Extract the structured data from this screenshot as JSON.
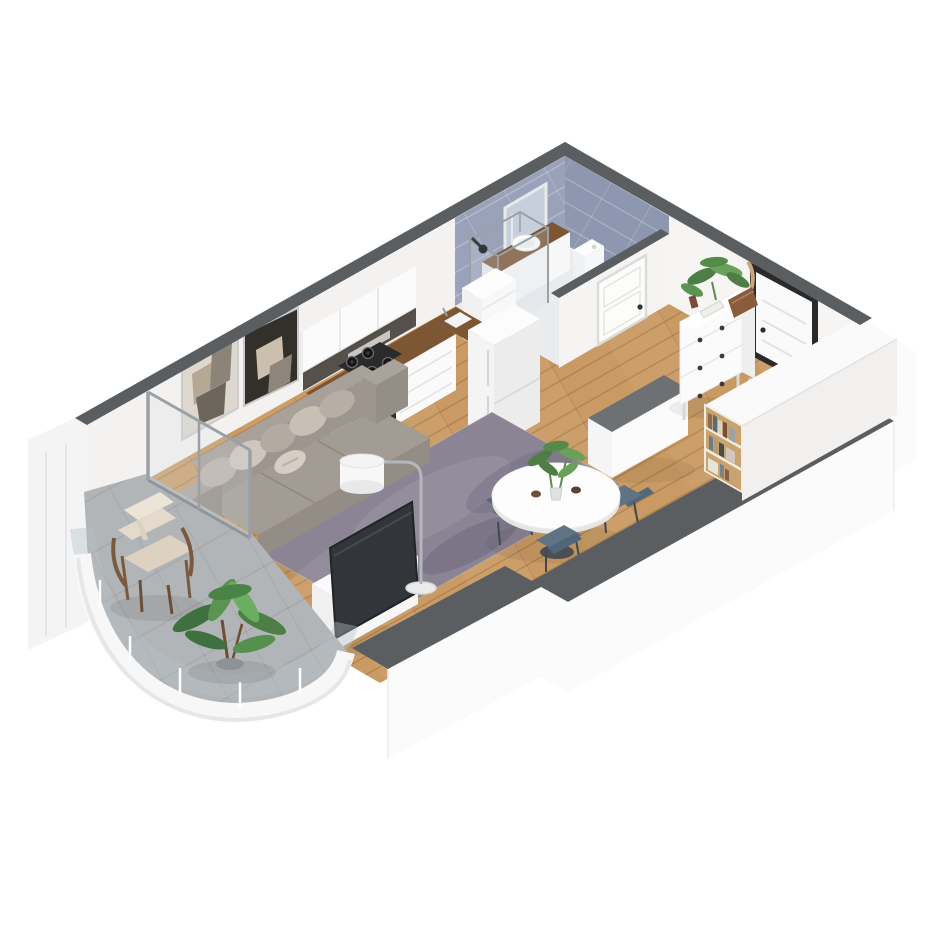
{
  "scene": {
    "description": "Isometric 3D rendering of a studio apartment floor plan, viewed from above at an angle, cut-away walls",
    "projection": "isometric",
    "rooms": [
      {
        "name": "bathroom",
        "items": [
          "shower-enclosure",
          "shower-head",
          "mirror-cabinet",
          "vanity-sink",
          "toilet",
          "bathroom-cabinet",
          "bathroom-door"
        ]
      },
      {
        "name": "kitchen",
        "items": [
          "upper-cabinets",
          "extractor",
          "gas-hob",
          "oven",
          "base-cabinets",
          "kitchen-sink",
          "fridge"
        ]
      },
      {
        "name": "living-room",
        "items": [
          "sofa",
          "throw-pillows",
          "area-rug",
          "tv",
          "tv-stand",
          "arc-floor-lamp",
          "wall-art-light",
          "wall-art-dark",
          "sliding-glass-door"
        ]
      },
      {
        "name": "dining-area",
        "items": [
          "round-dining-table",
          "dining-chair-left",
          "dining-chair-right",
          "dining-chair-front",
          "plant-centerpiece",
          "console-table"
        ]
      },
      {
        "name": "entry-hall",
        "items": [
          "chest-of-drawers",
          "potted-plant",
          "decor-basket",
          "entry-door",
          "wardrobe-partition",
          "bookshelf"
        ]
      },
      {
        "name": "balcony",
        "items": [
          "armchair",
          "throw-blanket",
          "potted-plant-large",
          "curved-glass-railing",
          "side-panel"
        ]
      }
    ],
    "colors": {
      "bg": "#ffffff",
      "wall_top": "#5b5e61",
      "wall_face": "#f4f2f0",
      "wall_outer": "#fbfbfb",
      "tile_nw": "#9aa2ba",
      "tile_ne": "#8e97b0",
      "floor_wood": "#c99a63",
      "floor_bath": "#e9ebee",
      "floor_balcony": "#b2b5b7",
      "rug": "#8b8494",
      "sofa": "#a39c95",
      "sofa_dark": "#948d86",
      "pillow_light": "#cfc7bd",
      "chair": "#5f7384",
      "counter_wood": "#7d5634",
      "backsplash": "#56504b",
      "cabinet_white": "#fafafa",
      "appliance_dark": "#2c2d2f",
      "plant_green": "#4e7d46",
      "plant_green_light": "#6aa05a",
      "bookshelf_wood": "#c9a36f",
      "door_frame": "#2a2a2a",
      "lamp_metal": "#b3b7ba",
      "glass": "#d7e0e5"
    }
  }
}
